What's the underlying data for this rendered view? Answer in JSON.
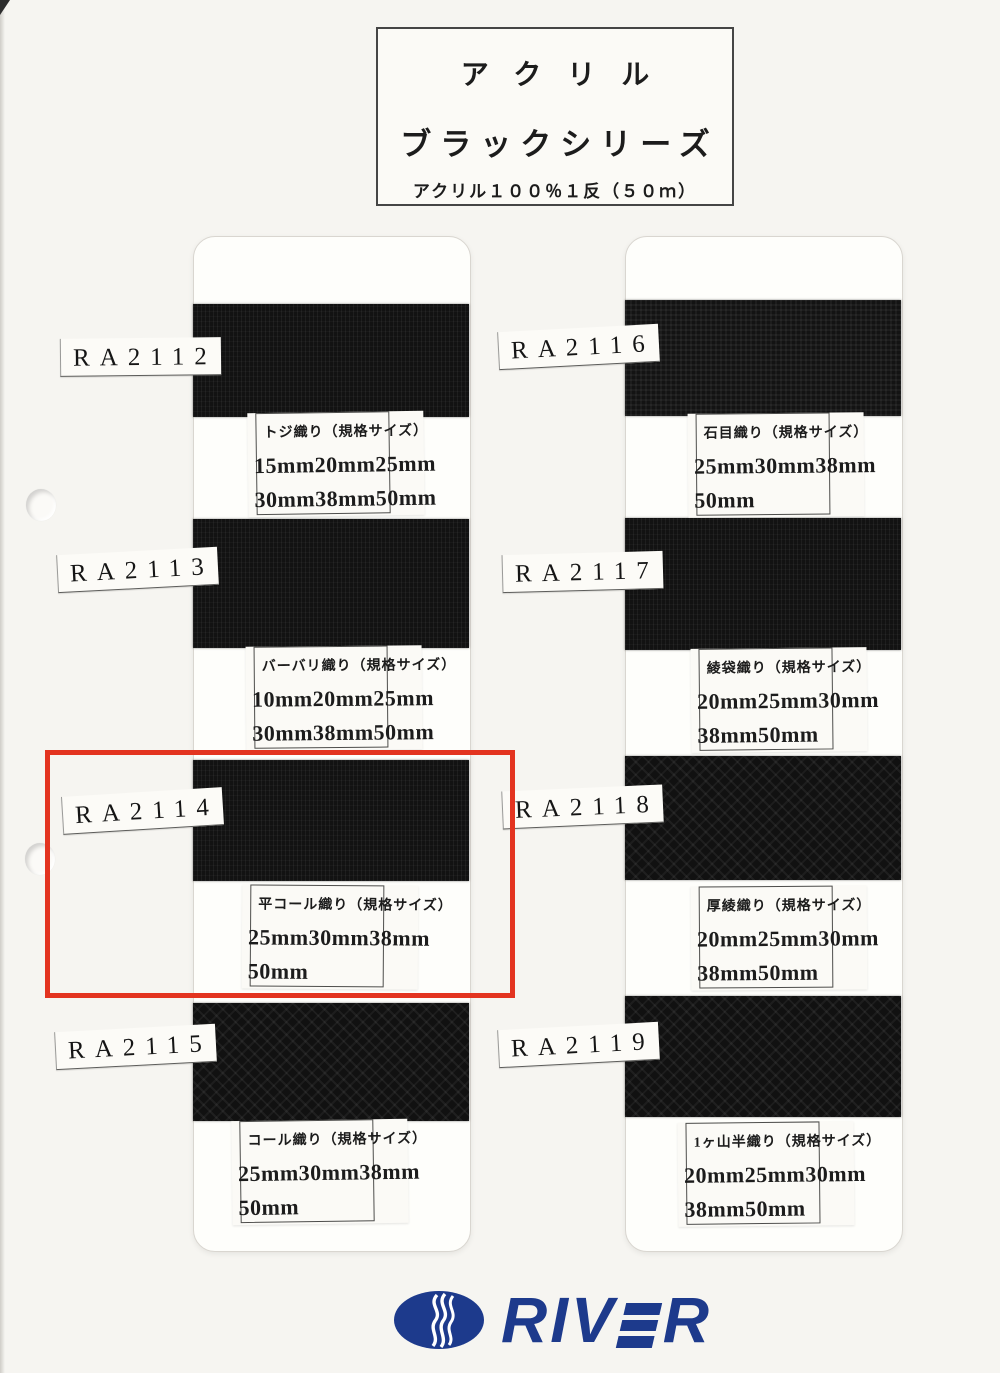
{
  "header": {
    "line1": "アクリル",
    "line2": "ブラックシリーズ",
    "line3": "アクリル１００％１反（５０ｍ）"
  },
  "left_column": {
    "samples": [
      {
        "code": "RA2112",
        "weave_texture": "rib",
        "spec_title": "トジ織り（規格サイズ）",
        "sizes1": "15mm20mm25mm",
        "sizes2": "30mm38mm50mm"
      },
      {
        "code": "RA2113",
        "weave_texture": "rib",
        "spec_title": "バーバリ織り（規格サイズ）",
        "sizes1": "10mm20mm25mm",
        "sizes2": "30mm38mm50mm"
      },
      {
        "code": "RA2114",
        "weave_texture": "rib",
        "spec_title": "平コール織り（規格サイズ）",
        "sizes1": "25mm30mm38mm",
        "sizes2": "50mm"
      },
      {
        "code": "RA2115",
        "weave_texture": "herringbone",
        "spec_title": "コール織り（規格サイズ）",
        "sizes1": "25mm30mm38mm",
        "sizes2": "50mm"
      }
    ]
  },
  "right_column": {
    "samples": [
      {
        "code": "RA2116",
        "weave_texture": "basket",
        "spec_title": "石目織り（規格サイズ）",
        "sizes1": "25mm30mm38mm",
        "sizes2": "50mm"
      },
      {
        "code": "RA2117",
        "weave_texture": "rib",
        "spec_title": "綾袋織り（規格サイズ）",
        "sizes1": "20mm25mm30mm",
        "sizes2": "38mm50mm"
      },
      {
        "code": "RA2118",
        "weave_texture": "herringbone",
        "spec_title": "厚綾織り（規格サイズ）",
        "sizes1": "20mm25mm30mm",
        "sizes2": "38mm50mm"
      },
      {
        "code": "RA2119",
        "weave_texture": "herringbone",
        "spec_title": "1ヶ山半織り（規格サイズ）",
        "sizes1": "20mm25mm30mm",
        "sizes2": "38mm50mm"
      }
    ]
  },
  "highlight": {
    "target_code": "RA2114",
    "color": "#e33420"
  },
  "logo": {
    "icon": "river-wave-oval-icon",
    "brand": "RIVER",
    "brand_prefix": "RIV",
    "brand_suffix": "R",
    "navy": "#1d3a8c"
  }
}
